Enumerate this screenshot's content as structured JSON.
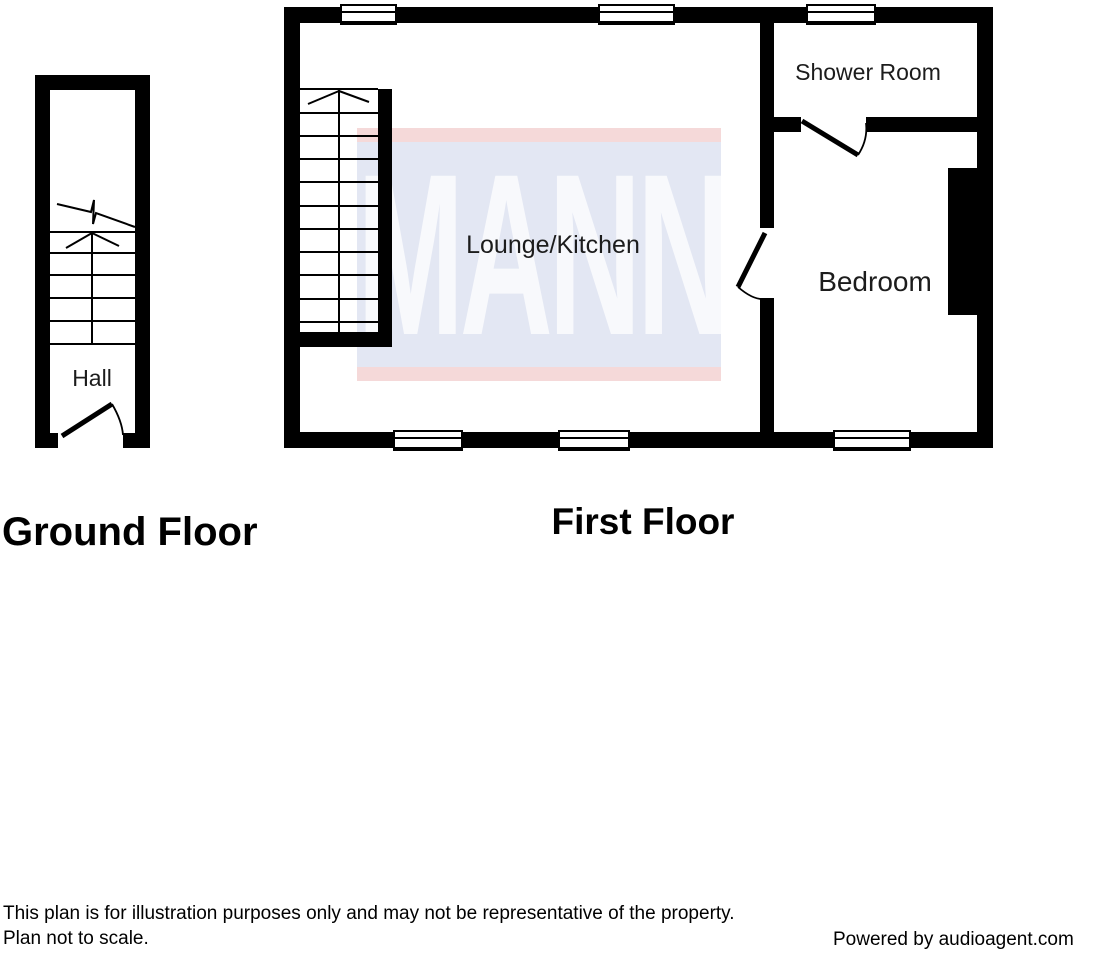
{
  "floors": [
    {
      "title": "Ground Floor",
      "rooms": [
        "Hall"
      ]
    },
    {
      "title": "First Floor",
      "rooms": [
        "Lounge/Kitchen",
        "Shower Room",
        "Bedroom"
      ]
    }
  ],
  "watermark": {
    "text": "MANN",
    "stripe_color": "#f5d9d9",
    "band_color": "#e3e7f3",
    "letter_color": "#f8f9fc"
  },
  "footer": {
    "disclaimer_line1": "This plan is for illustration purposes only and may not be representative of the property.",
    "disclaimer_line2": "Plan not to scale.",
    "credit": "Powered by audioagent.com"
  }
}
